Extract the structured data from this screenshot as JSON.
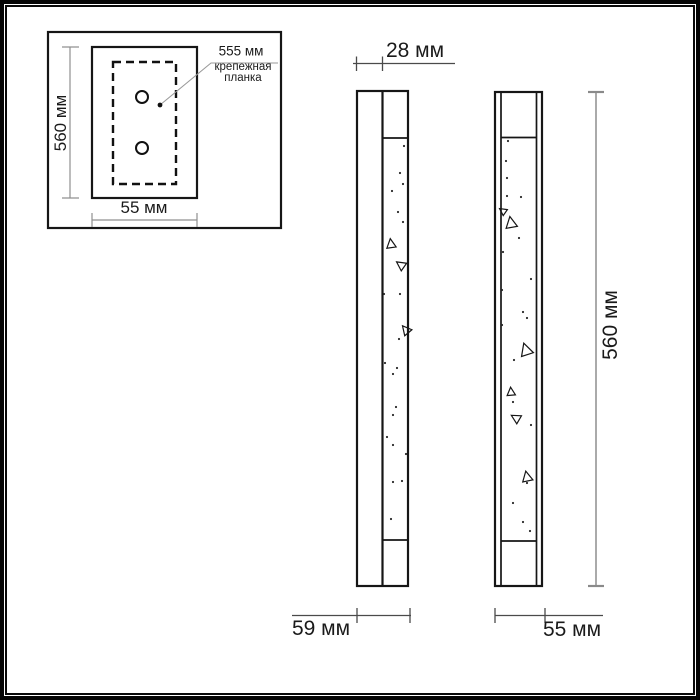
{
  "inset": {
    "label_size": "555 мм",
    "caption_line1": "крепежная",
    "caption_line2": "планка",
    "dim_height": "560 мм",
    "dim_width": "55 мм"
  },
  "side_view": {
    "dim_top": "28 мм",
    "dim_bottom": "59 мм"
  },
  "front_view": {
    "dim_height": "560 мм",
    "dim_width": "55 мм"
  },
  "colors": {
    "line": "#161616",
    "dimension": "#4a4a4a",
    "dimension_light": "#909090",
    "background": "#ffffff"
  },
  "specks": {
    "side": {
      "dots": [
        [
          398,
          212
        ],
        [
          403,
          222
        ],
        [
          404,
          146
        ],
        [
          400,
          173
        ],
        [
          403,
          184
        ],
        [
          392,
          191
        ],
        [
          384,
          294
        ],
        [
          400,
          294
        ],
        [
          399,
          339
        ],
        [
          385,
          363
        ],
        [
          397,
          368
        ],
        [
          393,
          374
        ],
        [
          396,
          407
        ],
        [
          393,
          415
        ],
        [
          387,
          437
        ],
        [
          393,
          445
        ],
        [
          406,
          454
        ],
        [
          402,
          481
        ],
        [
          393,
          482
        ],
        [
          391,
          519
        ]
      ],
      "triangles": [
        {
          "x": 391,
          "y": 244,
          "s": 9,
          "r": -8
        },
        {
          "x": 401,
          "y": 265,
          "s": 9,
          "r": -55
        },
        {
          "x": 406,
          "y": 330,
          "s": 9,
          "r": -40
        }
      ]
    },
    "front": {
      "dots": [
        [
          508,
          141
        ],
        [
          506,
          161
        ],
        [
          507,
          178
        ],
        [
          507,
          196
        ],
        [
          521,
          197
        ],
        [
          519,
          238
        ],
        [
          503,
          252
        ],
        [
          531,
          279
        ],
        [
          502,
          290
        ],
        [
          523,
          312
        ],
        [
          527,
          318
        ],
        [
          502,
          325
        ],
        [
          514,
          360
        ],
        [
          513,
          402
        ],
        [
          531,
          425
        ],
        [
          527,
          483
        ],
        [
          513,
          503
        ],
        [
          523,
          522
        ],
        [
          530,
          531
        ]
      ],
      "triangles": [
        {
          "x": 503,
          "y": 211,
          "s": 7,
          "r": -55
        },
        {
          "x": 511,
          "y": 223,
          "s": 11,
          "r": -10
        },
        {
          "x": 526,
          "y": 350,
          "s": 12,
          "r": -18
        },
        {
          "x": 511,
          "y": 392,
          "s": 8,
          "r": -5
        },
        {
          "x": 516,
          "y": 418,
          "s": 9,
          "r": -60
        },
        {
          "x": 527,
          "y": 477,
          "s": 10,
          "r": -12
        }
      ]
    }
  }
}
